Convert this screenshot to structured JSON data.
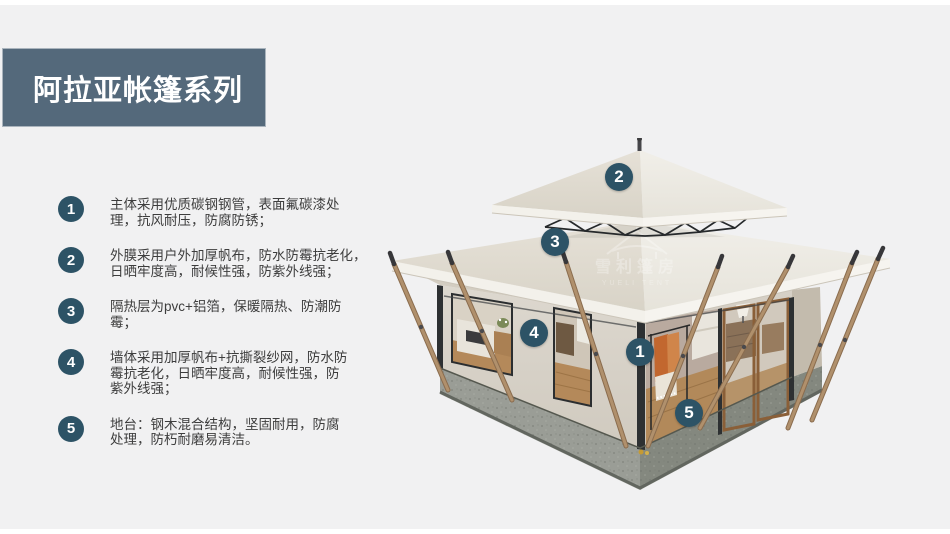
{
  "slide": {
    "background": "#f1f1f2",
    "top_strip_color": "#ffffff",
    "bottom_strip_color": "#ffffff"
  },
  "title": {
    "text": "阿拉亚帐篷系列",
    "bg_color": "#54697b",
    "text_color": "#ffffff"
  },
  "features": [
    {
      "num": "1",
      "lines": [
        "主体采用优质碳钢钢管，表面氟碳漆处",
        "理，抗风耐压，防腐防锈；"
      ]
    },
    {
      "num": "2",
      "lines": [
        "外膜采用户外加厚帆布，防水防霉抗老化，",
        "日晒牢度高，耐候性强，防紫外线强；"
      ]
    },
    {
      "num": "3",
      "lines": [
        "隔热层为pvc+铝箔，保暖隔热、防潮防",
        "霉；"
      ]
    },
    {
      "num": "4",
      "lines": [
        "墙体采用加厚帆布+抗撕裂纱网，防水防",
        "霉抗老化，日晒牢度高，耐候性强，防",
        "紫外线强；"
      ]
    },
    {
      "num": "5",
      "lines": [
        "地台：钢木混合结构，坚固耐用，防腐",
        "处理，防朽耐磨易清洁。"
      ]
    }
  ],
  "callouts": [
    {
      "num": "1",
      "x": 640,
      "y": 352
    },
    {
      "num": "2",
      "x": 619,
      "y": 177
    },
    {
      "num": "3",
      "x": 555,
      "y": 242
    },
    {
      "num": "4",
      "x": 534,
      "y": 333
    },
    {
      "num": "5",
      "x": 689,
      "y": 413
    }
  ],
  "watermark": {
    "cn": "雪利篷房",
    "en": "YUELI TENT"
  },
  "colors": {
    "badge": "#2d5366",
    "banner": "#54697b",
    "body_text": "#3d3d3d",
    "roof_light": "#efede6",
    "roof_dark": "#ddd8cd",
    "wall": "#d8d3c9",
    "platform": "#8d9189",
    "wood_pole": "#b0906c",
    "floor_wood": "#b2895a",
    "clothes_orange": "#c2672f"
  }
}
